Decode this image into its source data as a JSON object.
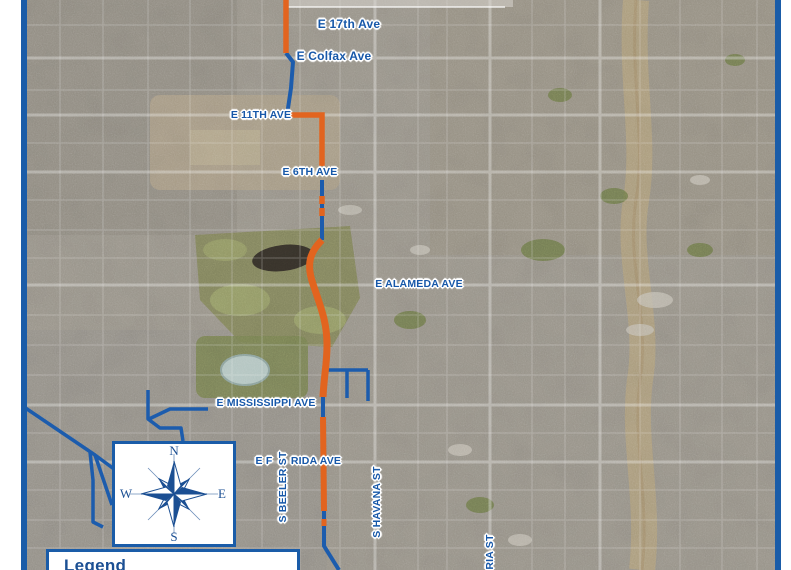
{
  "map": {
    "street_labels": {
      "e_17th": "E 17th Ave",
      "e_colfax": "E Colfax Ave",
      "e_11th": "E 11TH AVE",
      "e_6th": "E 6TH AVE",
      "e_alameda": "E ALAMEDA AVE",
      "e_mississippi": "E MISSISSIPPI AVE",
      "e_florida_left": "E F",
      "e_florida_right": "RIDA AVE",
      "s_beeler": "S BEELER ST",
      "s_havana": "S HAVANA ST",
      "s_peoria_partial": "RIA ST"
    },
    "compass": {
      "n": "N",
      "e": "E",
      "s": "S",
      "w": "W"
    },
    "legend_title": "Legend",
    "colors": {
      "route_orange": "#E2641F",
      "line_blue": "#1C5CAD",
      "frame_blue": "#1A5CA8",
      "label_blue": "#1758A9",
      "compass_navy": "#1B4F93"
    }
  }
}
